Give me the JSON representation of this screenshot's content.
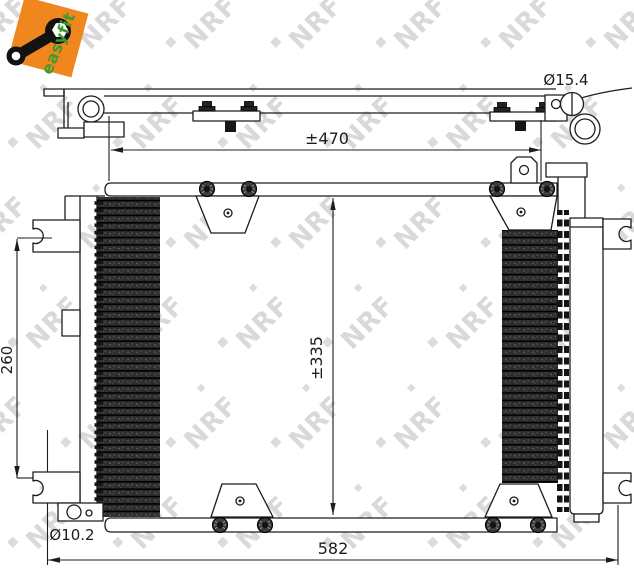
{
  "logo": {
    "brand": "easyfit"
  },
  "watermark": {
    "text": "NRF"
  },
  "colors": {
    "logo_orange": "#F0861E",
    "logo_green": "#3E9B2F",
    "line_color": "#1C1C1C",
    "watermark_gray": "#D9D9D9",
    "fin_dark": "#2E2E2E"
  },
  "views": {
    "top_view": {
      "width_label": "±470",
      "port_diameter_label": "Ø15.4"
    },
    "front_view": {
      "height_label": "±335",
      "left_height_label": "260",
      "bottom_width_label": "582",
      "bottom_port_diameter_label": "Ø10.2"
    }
  }
}
